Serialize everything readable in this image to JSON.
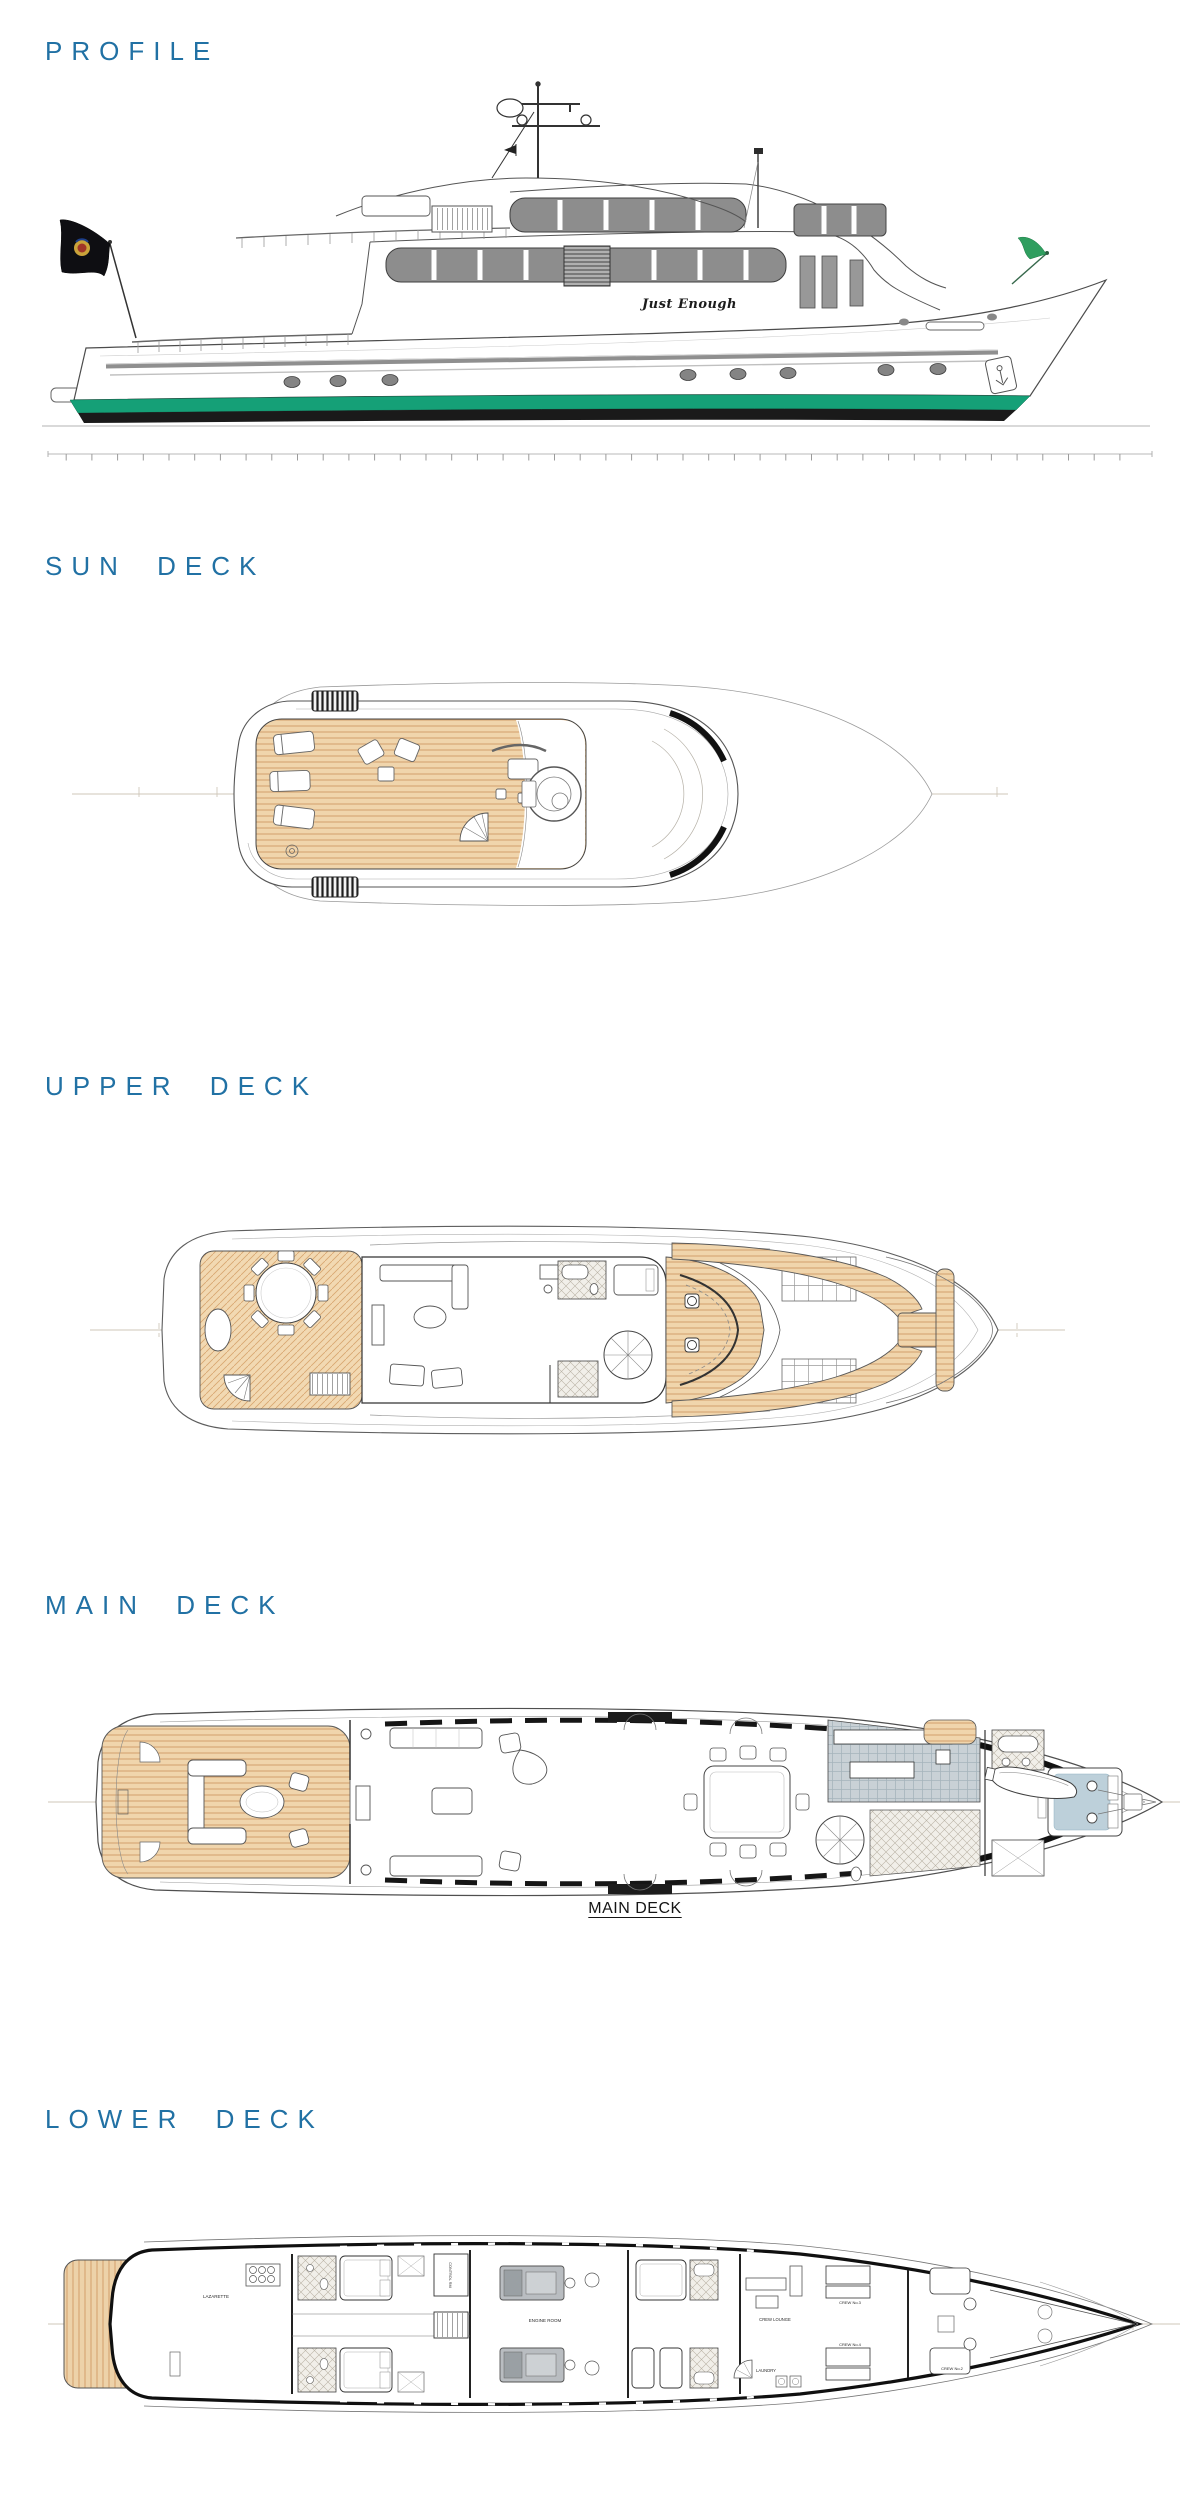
{
  "page": {
    "background": "#ffffff"
  },
  "colors": {
    "heading_blue": "#2171a4",
    "waterline_green": "#15a077",
    "boot_stripe_black": "#1a1a1a",
    "teak_deck": "#f0d5ac",
    "teak_plank_line": "#cf9a63",
    "window_band_gray": "#8d8d8d",
    "galley_floor_gray": "#c9d1d6",
    "master_bed_blue": "#bdd0da",
    "drawing_line": "#4f4f4f"
  },
  "sections": {
    "profile": {
      "heading": "PROFILE",
      "yacht_name": "Just Enough"
    },
    "sun_deck": {
      "heading": "SUN DECK"
    },
    "upper_deck": {
      "heading": "UPPER DECK"
    },
    "main_deck": {
      "heading": "MAIN DECK",
      "caption": "MAIN DECK"
    },
    "lower_deck": {
      "heading": "LOWER DECK",
      "rooms": {
        "lazarette": "LAZARETTE",
        "control_room": "CONTROL RM",
        "engine_room": "ENGINE ROOM",
        "crew_lounge": "CREW LOUNGE",
        "laundry": "LAUNDRY",
        "crew_2": "CREW No.2",
        "crew_3": "CREW No.3",
        "crew_4": "CREW No.4"
      }
    }
  }
}
